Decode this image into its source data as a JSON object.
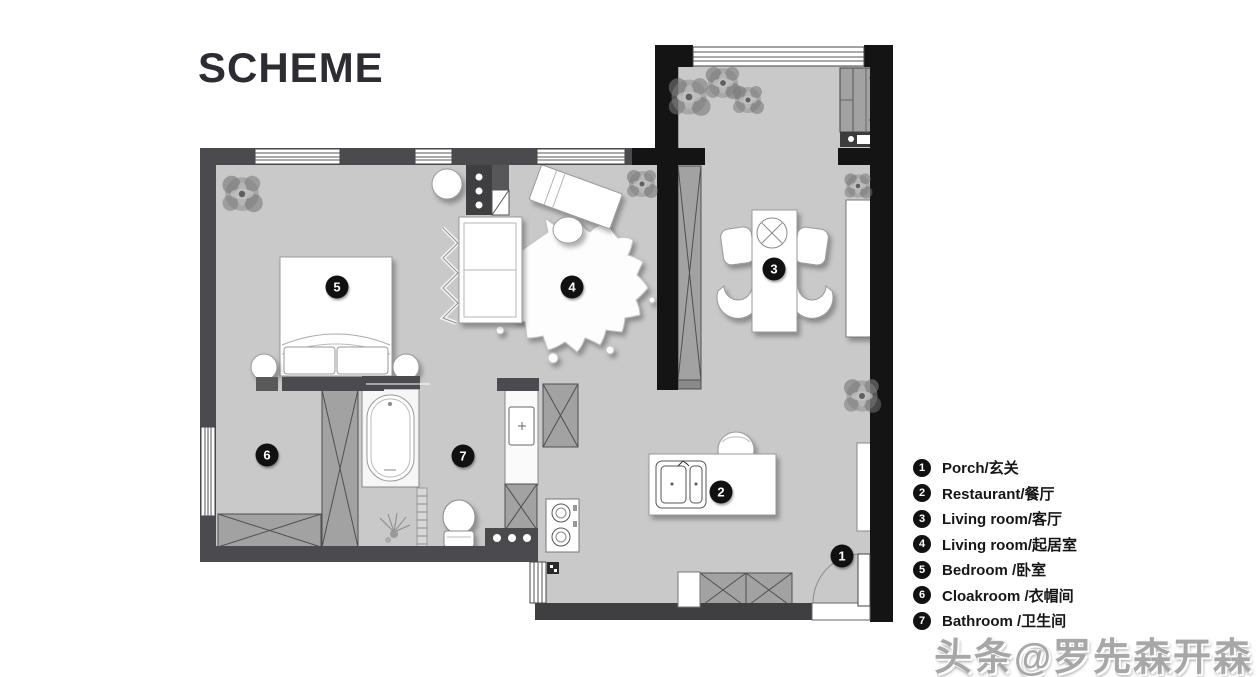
{
  "title": "SCHEME",
  "legend": {
    "items": [
      {
        "num": "1",
        "label": "Porch/玄关"
      },
      {
        "num": "2",
        "label": "Restaurant/餐厅"
      },
      {
        "num": "3",
        "label": "Living room/客厅"
      },
      {
        "num": "4",
        "label": "Living room/起居室"
      },
      {
        "num": "5",
        "label": "Bedroom  /卧室"
      },
      {
        "num": "6",
        "label": "Cloakroom  /衣帽间"
      },
      {
        "num": "7",
        "label": "Bathroom /卫生间"
      }
    ]
  },
  "watermark": {
    "text": "头条@罗先森开森"
  },
  "colors": {
    "wall_black": "#141414",
    "wall_gray": "#4b4b4f",
    "floor": "#c9c9c9",
    "cabinet_gray": "#a2a2a2",
    "furniture_white": "#ffffff",
    "marker_bg": "#111111",
    "title_text": "#2c2c33",
    "watermark_gray": "#a7a7a7"
  }
}
